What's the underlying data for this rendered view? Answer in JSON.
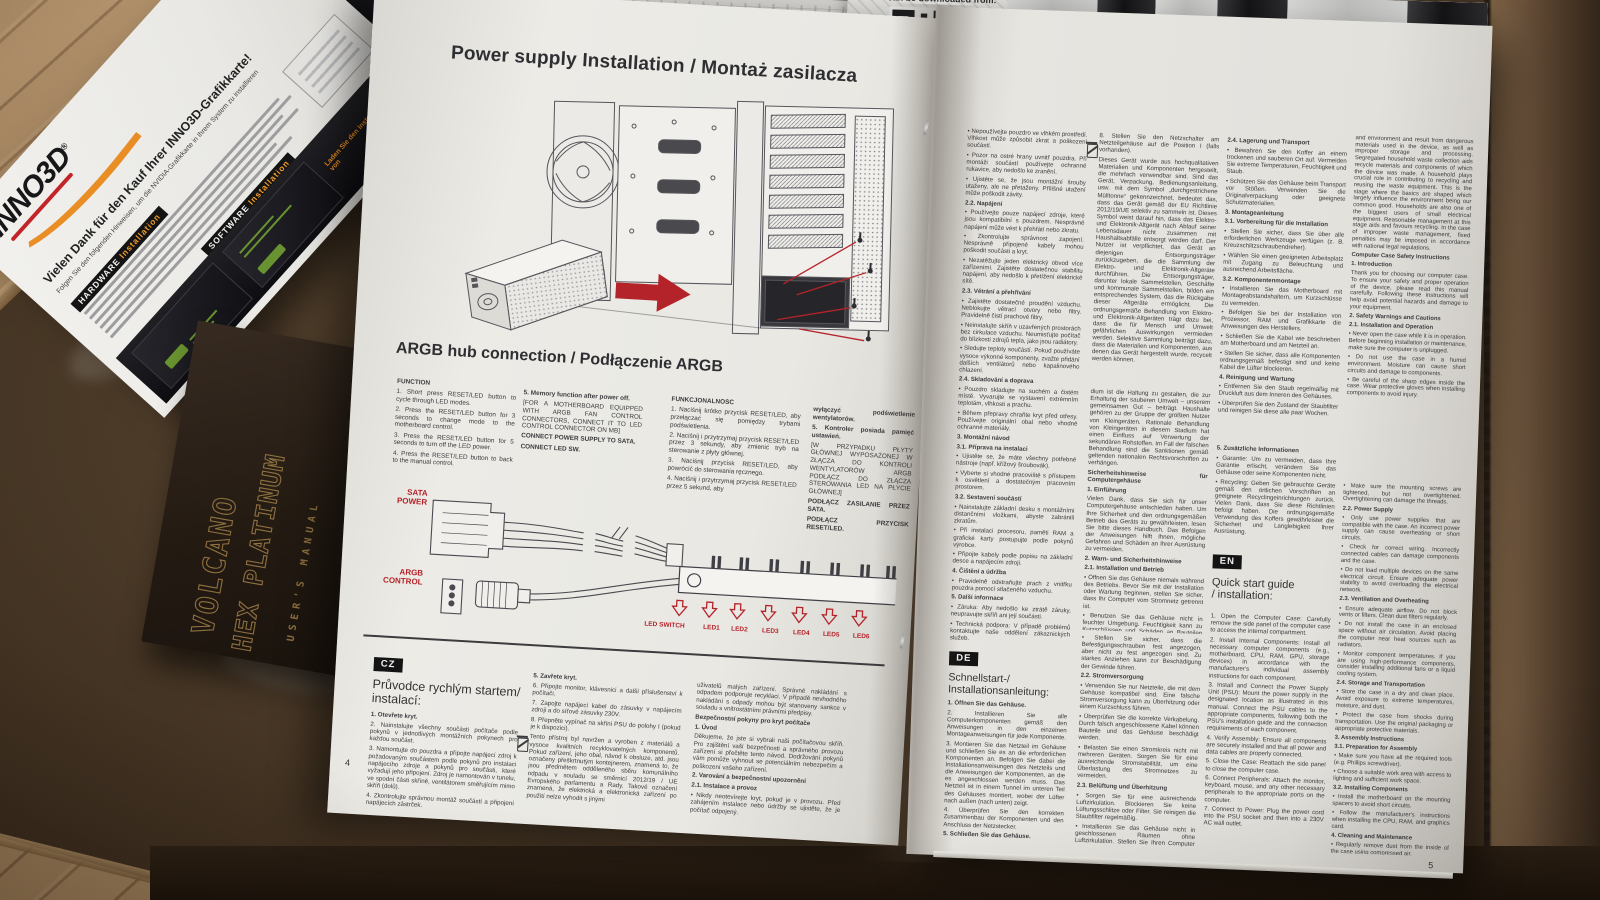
{
  "leaflet": {
    "brand": "INNO3D",
    "registered": "®",
    "heading": "Vielen Dank für den Kauf Ihrer INNO3D-Grafikkarte!",
    "subheading": "Folgen Sie den folgenden Hinweisen, um die NVIDIA-Grafikkarte in Ihrem System zu installieren",
    "hardware_label": "HARDWARE",
    "hardware_word": "Installation",
    "software_label": "SOFTWARE",
    "software_word": "Installation",
    "download_line": "Laden Sie den Installationstreiber von"
  },
  "booklet": {
    "title1": "VOLCANO",
    "title2": "HEX PLATINUM",
    "subtitle": "USER'S MANUAL"
  },
  "back_page": {
    "download_label": "can be downloaded from:"
  },
  "left_page": {
    "page_number": "4",
    "title": "Power supply Installation / Montaż zasilacza",
    "argb_title": "ARGB hub connection / Podłączenie ARGB",
    "col_en1": [
      "FUNCTION",
      "1. Short press RESET/LED button to cycle through LED modes.",
      "2. Press the RESET/LED button for 3 seconds to change mode to the motherboard control.",
      "3. Press the RESET/LED button for 5 seconds to turn off the LED power.",
      "4. Press the RESET/LED button to back to the manual control."
    ],
    "col_en2": [
      "5. Memory function after power off.",
      "[FOR A MOTHERBOARD EQUIPPED WITH ARGB FAN CONTROL CONNECTORS, CONNECT IT TO LED CONTROL CONNECTOR ON MB]",
      "CONNECT POWER SUPPLY TO SATA.",
      "CONNECT LED SW."
    ],
    "col_pl1": [
      "FUNKCJONALNOŚĆ",
      "1. Naciśnij krótko przycisk RESET/LED, aby przełączać się pomiędzy trybami podświetlenia.",
      "2. Naciśnij i przytrzymaj przycisk RESET/LED przez 3 sekundy, aby zmienić tryb na sterowanie z płyty głównej.",
      "3. Naciśnij przycisk RESET/LED, aby powrócić do sterowania ręcznego.",
      "4. Naciśnij i przytrzymaj przycisk RESET/LED przez 5 sekund, aby"
    ],
    "col_pl2": [
      "wyłączyć podświetlenie wentylatorów.",
      "5. Kontroler posiada pamięć ustawień.",
      "[W PRZYPADKU PŁYTY GŁÓWNEJ WYPOSAŻONEJ W ZŁĄCZA DO KONTROLI WENTYLATORÓW ARGB PODŁĄCZ DO ZŁĄCZA STEROWANIA LED NA PŁYCIE GŁÓWNEJ]",
      "PODŁĄCZ ZASILANIE PRZEZ SATA.",
      "PODŁĄCZ PRZYCISK RESET/LED."
    ],
    "labels": {
      "sata": "SATA\nPOWER",
      "argb": "ARGB\nCONTROL",
      "led_switch": "LED SWITCH",
      "leds": [
        "LED1",
        "LED2",
        "LED3",
        "LED4",
        "LED5",
        "LED6"
      ]
    },
    "cz_label": "CZ",
    "cz_heading": "Průvodce rychlým startem/\ninstalací:",
    "cz_col1": [
      "1. Otevřete kryt.",
      "2. Nainstalujte všechny součásti počítače podle pokynů v jednotlivých montážních pokynech pro každou součást.",
      "3. Namontujte do pouzdra a připojte napájecí zdroj k požadovaným součástem podle pokynů pro instalaci napájecího zdroje a pokynů pro součásti, které vyžadují jeho připojení. Zdroj je namontován v tunelu, ve spodní části skříně, ventilátorem směřujícím mimo skříň (dolů).",
      "4. Zkontrolujte správnou montáž součástí a připojení napájecích zástrček."
    ],
    "cz_col2": [
      "5. Zavřete kryt.",
      "6. Připojte monitor, klávesnici a další příslušenství k počítači.",
      "7. Zapojte napájecí kabel do zásuvky v napájecím zdroji a do síťové zásuvky 230V.",
      "8. Přepněte vypínač na skříni PSU do polohy I (pokud je k dispozici).",
      "Tento přístroj byl navržen a vyroben z materiálů a vysoce kvalitních recyklovatelných komponentů. Pokud zařízení, jeho obal, návod k obsluze, atd. jsou označeny přeškrtnutým kontejnerem, znamená to, že jsou předmětem odděleného sběru komunálního odpadu v souladu se směrnicí 2012/19 / UE Evropského parlamentu a Rady. Takové označení znamená, že elektrická a elektronická zařízení po použití nelze vyhodit s jinými"
    ],
    "cz_col3": [
      "uživatelů malých zařízení. Správné nakládání s odpadem podporuje recyklaci. V případě nevhodného nakládání s odpady mohou být stanoveny sankce v souladu s vnitrostátními právními předpisy.",
      "Bezpečnostní pokyny pro kryt počítače",
      "1. Úvod",
      "Děkujeme, že jste si vybrali naši počítačovou skříň. Pro zajištění vaší bezpečnosti a správného provozu zařízení si přečtěte tento návod. Dodržování pokynů vám pomůže vyhnout se potenciálním nebezpečím a poškození vašeho zařízení.",
      "2. Varování a bezpečnostní upozornění",
      "2.1. Instalace a provoz",
      "• Nikdy neotevírejte kryt, pokud je v provozu. Před zahájením instalace nebo údržby se ujistěte, že je počítač odpojený."
    ]
  },
  "right_page": {
    "page_number": "5",
    "col1_top": [
      "• Nepoužívejte pouzdro ve vlhkém prostředí. Vlhkost může způsobit zkrat a poškození součástí.",
      "• Pozor na ostré hrany uvnitř pouzdra. Při montáži součástí používejte ochranné rukavice, aby nedošlo ke zranění.",
      "• Ujistěte se, že jsou montážní šrouby utaženy, ale ne přetaženy. Přílišné utažení může poškodit závity.",
      "2.2. Napájení",
      "• Používejte pouze napájecí zdroje, které jsou kompatibilní s pouzdrem. Nesprávné napájení může vést k přehřátí nebo zkratu.",
      "• Zkontrolujte správnost zapojení. Nesprávně připojené kabely mohou poškodit součásti a kryt.",
      "• Nezatěžujte jeden elektrický obvod více zařízeními. Zajistěte dostatečnou stabilitu napájení, aby nedošlo k přetížení elektrické sítě.",
      "2.3. Větrání a přehřívání",
      "• Zajistěte dostatečné proudění vzduchu. Neblokujte větrací otvory nebo filtry. Pravidelně čistí prachové filtry.",
      "• Neinstalujte skříň v uzavřených prostorách bez cirkulace vzduchu. Neumisťujte počítač do blízkosti zdrojů tepla, jako jsou radiátory.",
      "• Sledujte teploty součástí. Pokud používáte vysoce výkonné komponenty, zvažte přidání dalších ventilátorů nebo kapalinového chlazení.",
      "2.4. Skladování a doprava",
      "• Pouzdro skladujte na suchém a čistém místě. Vyvarujte se vystavení extrémním teplotám, vlhkosti a prachu.",
      "• Během přepravy chraňte kryt před otřesy. Používejte originální obal nebo vhodné ochranné materiály."
    ],
    "col1_mid": [
      "3. Montážní návod",
      "3.1. Příprava na instalaci",
      "• Ujistěte se, že máte všechny potřebné nástroje (např. křížový šroubovák).",
      "• Vyberte si vhodné pracoviště s přístupem k osvětlení a dostatečným pracovním prostorem.",
      "3.2. Sestavení součástí",
      "• Nainstalujte základní desku s montážními distančními vložkami, abyste zabránili zkratům.",
      "• Při instalaci procesoru, paměti RAM a grafické karty postupujte podle pokynů výrobce.",
      "• Připojte kabely podle popisu na základní desce a napájecím zdroji.",
      "4. Čištění a údržba",
      "• Pravidelně odstraňujte prach z vnitřku pouzdra pomocí stlačeného vzduchu.",
      "5. Další informace",
      "• Záruka: Aby nedošlo ke ztrátě záruky, neupravujte skříň ani její součásti.",
      "• Technická podpora: V případě problémů kontaktujte naše oddělení zákaznických služeb.",
      "• Recyklace: Vraťte použitá zařízení do příslušných recyklačních zařízení v souladu s místními předpisy.",
      "Děkujeme za dodržování těchto pokynů. Správné používání pouzdra zajistí bezpečnost a dlouhou životnost vašeho vybavení."
    ],
    "de_label": "DE",
    "de_heading": "Schnellstart-/\nInstallationsanleitung:",
    "de_steps": [
      "1. Öffnen Sie das Gehäuse.",
      "2. Installieren Sie alle Computerkomponenten gemäß den Anweisungen in den einzelnen Montageanweisungen für jede Komponente.",
      "3. Montieren Sie das Netzteil im Gehäuse und schließen Sie es an die erforderlichen Komponenten an. Befolgen Sie dabei die Installationsanweisungen des Netzteils und die Anweisungen der Komponenten, an die es angeschlossen werden muss. Das Netzteil ist in einem Tunnel im unteren Teil des Gehäuses montiert, wobei der Lüfter nach außen (nach unten) zeigt.",
      "4. Überprüfen Sie den korrekten Zusammenbau der Komponenten und den Anschluss der Netzstecker.",
      "5. Schließen Sie das Gehäuse.",
      "6. Schließen Sie Monitor, Tastatur und anderes Zubehör an den Computer an.",
      "7. Schließen Sie das Netzkabel an die Buchse des Netzteils und an die 230-V-Netzsteckdose an."
    ],
    "col2_a": [
      "8. Stellen Sie den Netzschalter am Netzteilgehäuse auf die Position I (falls vorhanden).",
      "Dieses Gerät wurde aus hochqualitativen Materialien und Komponenten hergestellt, die mehrfach verwendbar sind. Sind das Gerät, Verpackung, Bedienungsanleitung, usw. mit dem Symbol „durchgestrichene Mülltonne“ gekennzeichnet, bedeutet das, dass das Gerät gemäß der EU Richtlinie 2012/19/UE selektiv zu sammeln ist. Dieses Symbol weist darauf hin, dass das Elektro- und Elektronik-Altgerät nach Ablauf seiner Lebensdauer nicht zusammen mit Haushaltsabfälle entsorgt werden darf. Der Nutzer ist verpflichtet, das Gerät an diejenigen Entsorgungsträger zurückzugeben, die die Sammlung der Elektro- und Elektronik-Altgeräte durchführen. Die Entsorgungsträger, darunter lokale Sammelstellen, Geschäfte und kommunale Sammelstellen, bilden ein entsprechendes System, das die Rückgabe dieser Altgeräte ermöglicht. Die ordnungsgemäße Behandlung von Elektro- und Elektronik-Altgeräten trägt dazu bei, dass die für Mensch und Umwelt gefährlichen Auswirkungen vermieden werden. Selektive Sammlung beiträgt dazu, dass die Materialien und Komponenten, aus denen das Gerät hergestellt wurde, recycelt werden können."
    ],
    "col2_b": [
      "dium ist die Haltung zu gestalten, die zur Erhaltung der sauberen Umwelt – unserem gemeinsamen Gut – beiträgt. Haushalte gehören zu der Gruppe der größten Nutzer von Kleingeräten. Rationale Behandlung von Kleingeräten in diesem Stadium hat einen Einfluss auf Verwertung der sekundären Rohstoffen. Im Fall der falschen Behandlung sind die Sanktionen gemäß geltenden nationalen Rechtsvorschriften zu verhängen.",
      "Sicherheitshinweise für Computergehäuse",
      "1. Einführung",
      "Vielen Dank, dass Sie sich für unser Computergehäuse entschieden haben. Um Ihre Sicherheit und den ordnungsgemäßen Betrieb des Geräts zu gewährleisten, lesen Sie bitte dieses Handbuch. Das Befolgen der Anweisungen hilft Ihnen, mögliche Gefahren und Schäden an Ihrer Ausrüstung zu vermeiden.",
      "2. Warn- und Sicherheitshinweise",
      "2.1. Installation und Betrieb",
      "• Öffnen Sie das Gehäuse niemals während des Betriebs. Bevor Sie mit der Installation oder Wartung beginnen, stellen Sie sicher, dass Ihr Computer vom Stromnetz getrennt ist.",
      "• Benutzen Sie das Gehäuse nicht in feuchter Umgebung. Feuchtigkeit kann zu Kurzschlüssen und Schäden an Bauteilen führen.",
      "• Achten Sie auf scharfe Kanten im Inneren des Gehäuses. Tragen Sie beim Zusammenbau der Komponenten Schutzhandschuhe, um Verletzungen zu vermeiden."
    ],
    "col2_c": [
      "• Stellen Sie sicher, dass die Befestigungsschrauben fest angezogen, aber nicht zu fest angezogen sind. Zu starkes Anziehen kann zur Beschädigung der Gewinde führen.",
      "2.2. Stromversorgung",
      "• Verwenden Sie nur Netzteile, die mit dem Gehäuse kompatibel sind. Eine falsche Stromversorgung kann zu Überhitzung oder einem Kurzschluss führen.",
      "• Überprüfen Sie die korrekte Verkabelung. Durch falsch angeschlossene Kabel können Bauteile und das Gehäuse beschädigt werden.",
      "• Belasten Sie einen Stromkreis nicht mit mehreren Geräten. Sorgen Sie für eine ausreichende Stromstabilität, um eine Überlastung des Stromnetzes zu vermeiden.",
      "2.3. Belüftung und Überhitzung",
      "• Sorgen Sie für eine ausreichende Luftzirkulation. Blockieren Sie keine Lüftungsschlitze oder Filter. Sie reinigen die Staubfilter regelmäßig.",
      "• Installieren Sie das Gehäuse nicht in geschlossenen Räumen ohne Luftzirkulation. Stellen Sie Ihren Computer nicht in der Nähe von Wärmequellen wie Heizkörpern auf.",
      "• Überwachen Sie die Komponententemperaturen. Wenn Sie Hochleistungskomponenten verwenden, denken Sie darüber nach, zusätzliche Lüfter oder ein Flüssigkeitskühlsystem hinzuzufügen."
    ],
    "col3_a": [
      "2.4. Lagerung und Transport",
      "• Bewahren Sie den Koffer an einem trockenen und sauberen Ort auf. Vermeiden Sie extreme Temperaturen, Feuchtigkeit und Staub.",
      "• Schützen Sie das Gehäuse beim Transport vor Stößen. Verwenden Sie die Originalverpackung oder geeignete Schutzmaterialien.",
      "3. Montageanleitung",
      "3.1. Vorbereitung für die Installation",
      "• Stellen Sie sicher, dass Sie über alle erforderlichen Werkzeuge verfügen (z. B. Kreuzschlitzschraubendreher).",
      "• Wählen Sie einen geeigneten Arbeitsplatz mit Zugang zu Beleuchtung und ausreichend Arbeitsfläche.",
      "3.2. Komponentenmontage",
      "• Installieren Sie das Motherboard mit Montageabstandshaltern, um Kurzschlüsse zu vermeiden.",
      "• Befolgen Sie bei der Installation von Prozessor, RAM und Grafikkarte die Anweisungen des Herstellers.",
      "• Schließen Sie die Kabel wie beschrieben am Motherboard und am Netzteil an.",
      "• Stellen Sie sicher, dass alle Komponenten ordnungsgemäß befestigt sind und keine Kabel die Lüfter blockieren.",
      "4. Reinigung und Wartung",
      "• Entfernen Sie den Staub regelmäßig mit Druckluft aus dem Inneren des Gehäuses.",
      "• Überprüfen Sie den Zustand der Staubfilter und reinigen Sie diese alle paar Wochen."
    ],
    "col3_b": [
      "5. Zusätzliche Informationen",
      "• Garantie: Um zu vermeiden, dass Ihre Garantie erlischt, verändern Sie das Gehäuse oder seine Komponenten nicht.",
      "• Recycling: Geben Sie gebrauchte Geräte gemäß den örtlichen Vorschriften an geeignete Recyclingeinrichtungen zurück. Vielen Dank, dass Sie diese Richtlinien befolgt haben. Die ordnungsgemäße Verwendung des Koffers gewährleistet die Sicherheit und Langlebigkeit Ihrer Ausrüstung."
    ],
    "en_label": "EN",
    "en_heading": "Quick start guide\n/ installation:",
    "en_steps": [
      "1. Open the Computer Case: Carefully remove the side panel of the computer case to access the internal compartment.",
      "2. Install Internal Components: Install all necessary computer components (e.g., motherboard, CPU, RAM, GPU, storage devices) in accordance with the manufacturer's individual assembly instructions for each component.",
      "3. Install and Connect the Power Supply Unit (PSU): Mount the power supply in the designated location as illustrated in this manual. Connect the PSU cables to the appropriate components, following both the PSU's installation guide and the connection requirements of each component.",
      "4. Verify Assembly: Ensure all components are securely installed and that all power and data cables are properly connected.",
      "5. Close the Case: Reattach the side panel to close the computer case.",
      "6. Connect Peripherals: Attach the monitor, keyboard, mouse, and any other necessary peripherals to the appropriate ports on the computer.",
      "7. Connect to Power: Plug the power cord into the PSU socket and then into a 230V AC wall outlet."
    ],
    "col4_a": [
      "and environment and result from dangerous materials used in the device, as well as improper storage and processing. Segregated household waste collection aids recycle materials and components of which the device was made. A household plays crucial role in contributing to recycling and reusing the waste equipment. This is the stage where the basics are shaped which largely influence the environment being our common good. Households are also one of the biggest users of small electrical equipment. Reasonable management at this stage aids and favours recycling. In the case of improper waste management, fixed penalties may be imposed in accordance with national legal regulations.",
      "Computer Case Safety Instructions",
      "1. Introduction",
      "Thank you for choosing our computer case. To ensure your safety and proper operation of the device, please read this manual carefully. Following these instructions will help avoid potential hazards and damage to your equipment.",
      "2. Safety Warnings and Cautions",
      "2.1. Installation and Operation",
      "• Never open the case while it is in operation. Before beginning installation or maintenance, make sure the computer is unplugged.",
      "• Do not use the case in a humid environment. Moisture can cause short circuits and damage to components.",
      "• Be careful of the sharp edges inside the case. Wear protective gloves when installing components to avoid injury."
    ],
    "col4_b": [
      "• Make sure the mounting screws are tightened, but not overtightened. Overtightening can damage the threads.",
      "2.2. Power Supply",
      "• Only use power supplies that are compatible with the case. An incorrect power supply can cause overheating or short circuits.",
      "• Check for correct wiring. Incorrectly connected cables can damage components and the case.",
      "• Do not load multiple devices on the same electrical circuit. Ensure adequate power stability to avoid overloading the electrical network.",
      "2.3. Ventilation and Overheating",
      "• Ensure adequate airflow. Do not block vents or filters. Clean dust filters regularly.",
      "• Do not install the case in an enclosed space without air circulation. Avoid placing the computer near heat sources such as radiators.",
      "• Monitor component temperatures. If you are using high-performance components, consider installing additional fans or a liquid cooling system.",
      "2.4. Storage and Transportation",
      "• Store the case in a dry and clean place. Avoid exposure to extreme temperatures, moisture, and dust.",
      "• Protect the case from shocks during transportation. Use the original packaging or appropriate protective materials.",
      "3. Assembly Instructions",
      "3.1. Preparation for Assembly",
      "• Make sure you have all the required tools (e.g. Phillips screwdriver).",
      "• Choose a suitable work area with access to lighting and sufficient work space.",
      "3.2. Installing Components",
      "• Install the motherboard on the mounting spacers to avoid short circuits.",
      "• Follow the manufacturer's instructions when installing the CPU, RAM, and graphics card.",
      "4. Cleaning and Maintenance",
      "• Regularly remove dust from the inside of the case using compressed air.",
      "5. Additional Information",
      "• Warranty: To avoid voiding the warranty, do not modify the case or its components.",
      "• Technical Support: In case of problems, contact our customer service department.",
      "• Recycling: Dispose of used devices at appropriate recycling points in accordance with local regulations. Thank you for following these guidelines. Proper use of the case will ensure the safety and longevity of your equipment."
    ]
  }
}
